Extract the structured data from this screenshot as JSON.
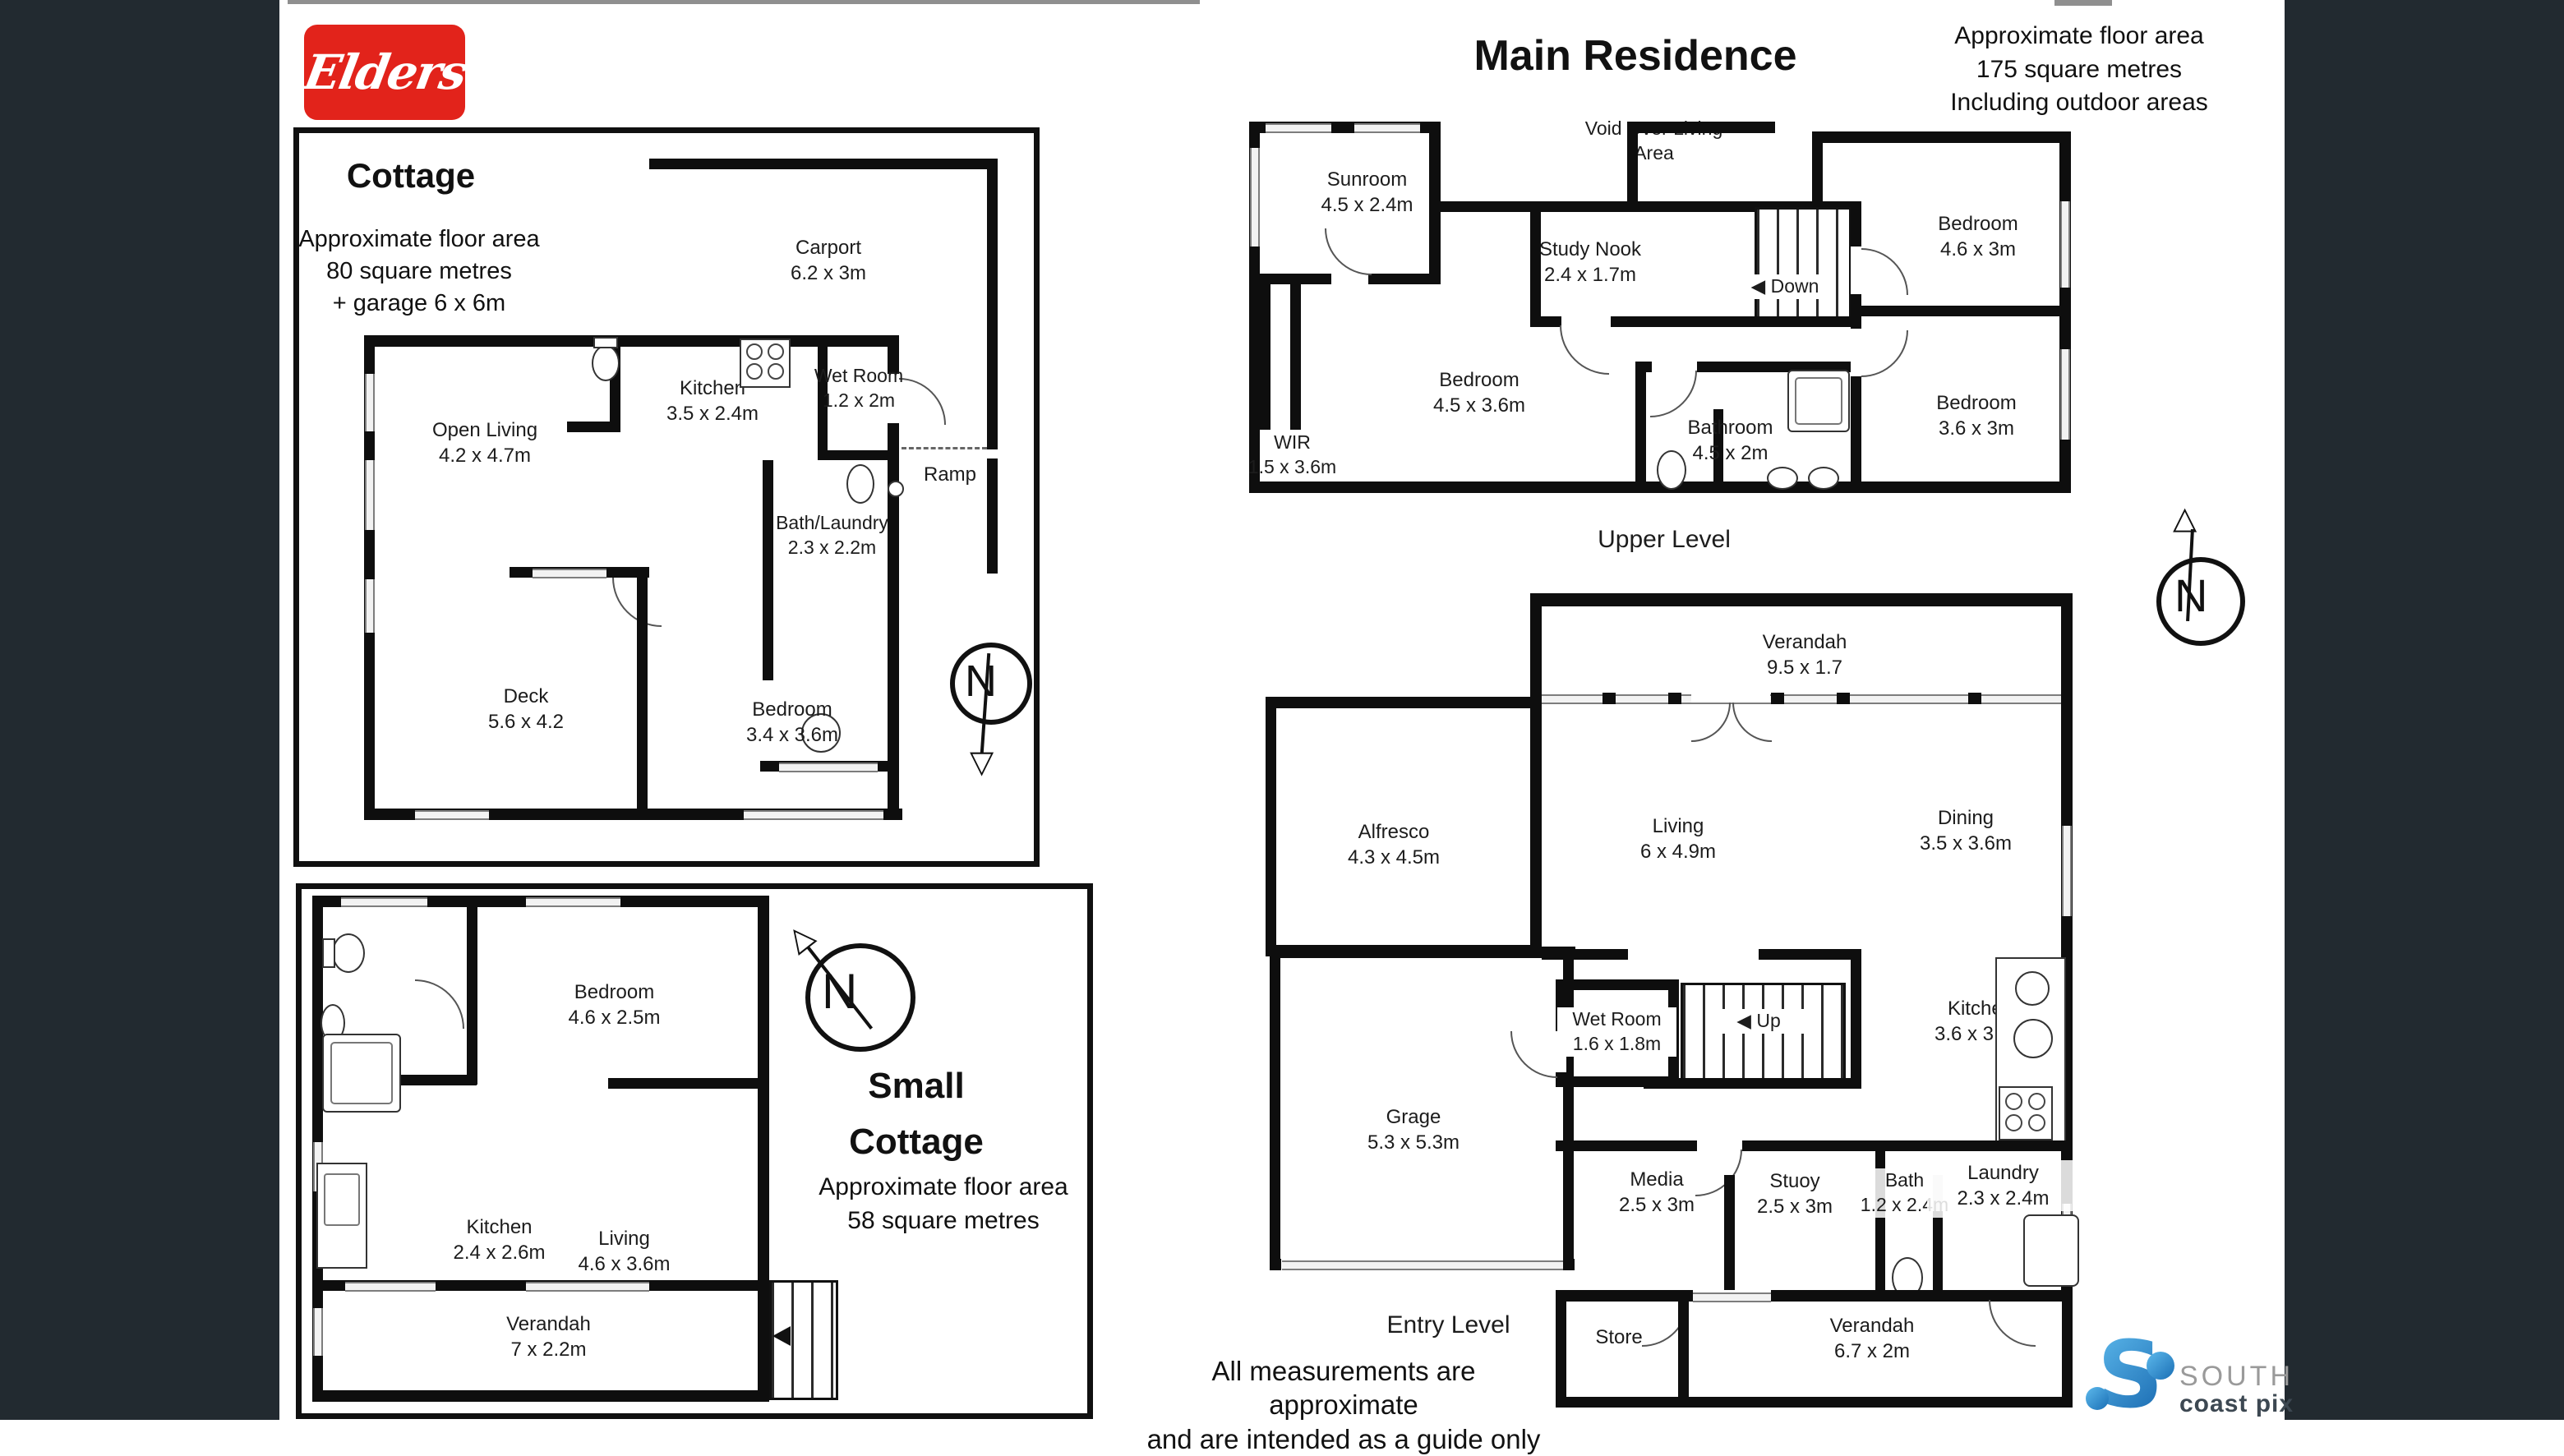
{
  "page": {
    "side_panel_color": "#222a30"
  },
  "logo": {
    "brand": "Elders",
    "brand_bg": "#e2231b"
  },
  "compass": {
    "letter": "N"
  },
  "icons": {
    "stair_arrow": "◀",
    "triangle_up": "△",
    "triangle_down": "▽"
  },
  "cottage": {
    "title": "Cottage",
    "area_lines": [
      "Approximate floor area",
      "80 square metres",
      "+ garage 6 x 6m"
    ],
    "rooms": [
      {
        "name": "Carport",
        "dims": "6.2 x 3m"
      },
      {
        "name": "Kitchen",
        "dims": "3.5 x 2.4m"
      },
      {
        "name": "Wet Room",
        "dims": "1.2 x 2m"
      },
      {
        "name": "Open Living",
        "dims": "4.2 x 4.7m"
      },
      {
        "name": "Bath/Laundry",
        "dims": "2.3 x 2.2m"
      },
      {
        "name": "Deck",
        "dims": "5.6 x 4.2"
      },
      {
        "name": "Bedroom",
        "dims": "3.4 x 3.6m"
      },
      {
        "name": "Ramp",
        "dims": ""
      }
    ]
  },
  "small_cottage": {
    "title_lines": [
      "Small",
      "Cottage"
    ],
    "area_lines": [
      "Approximate floor area",
      "58 square metres"
    ],
    "rooms": [
      {
        "name": "Bedroom",
        "dims": "4.6 x 2.5m"
      },
      {
        "name": "Kitchen",
        "dims": "2.4 x 2.6m"
      },
      {
        "name": "Living",
        "dims": "4.6 x 3.6m"
      },
      {
        "name": "Verandah",
        "dims": "7 x 2.2m"
      }
    ]
  },
  "main_residence": {
    "title": "Main Residence",
    "area_lines": [
      "Approximate floor area",
      "175 square metres",
      "Including outdoor areas"
    ],
    "upper": {
      "level_label": "Upper Level",
      "void_label": "Void Over Living Area",
      "stairs_label": "Down",
      "rooms": [
        {
          "name": "Sunroom",
          "dims": "4.5 x 2.4m"
        },
        {
          "name": "Study Nook",
          "dims": "2.4 x 1.7m"
        },
        {
          "name": "Bedroom",
          "dims": "4.6 x 3m"
        },
        {
          "name": "Bedroom",
          "dims": "4.5 x 3.6m"
        },
        {
          "name": "WIR",
          "dims": "1.5 x 3.6m"
        },
        {
          "name": "Bathroom",
          "dims": "4.5 x 2m"
        },
        {
          "name": "Bedroom",
          "dims": "3.6 x 3m"
        }
      ]
    },
    "entry": {
      "level_label": "Entry Level",
      "stairs_label": "Up",
      "rooms": [
        {
          "name": "Verandah",
          "dims": "9.5 x 1.7"
        },
        {
          "name": "Alfresco",
          "dims": "4.3 x 4.5m"
        },
        {
          "name": "Living",
          "dims": "6 x 4.9m"
        },
        {
          "name": "Dining",
          "dims": "3.5 x 3.6m"
        },
        {
          "name": "Wet Room",
          "dims": "1.6 x 1.8m"
        },
        {
          "name": "Kitchen",
          "dims": "3.6 x 3.6m"
        },
        {
          "name": "Grage",
          "dims": "5.3 x 5.3m"
        },
        {
          "name": "Media",
          "dims": "2.5 x 3m"
        },
        {
          "name": "Stuoy",
          "dims": "2.5 x 3m"
        },
        {
          "name": "Bath",
          "dims": "1.2 x 2.4m"
        },
        {
          "name": "Laundry",
          "dims": "2.3 x 2.4m"
        },
        {
          "name": "Store",
          "dims": ""
        },
        {
          "name": "Verandah",
          "dims": "6.7 x 2m"
        }
      ]
    }
  },
  "disclaimer": {
    "line1": "All measurements are approximate",
    "line2": "and are intended as a guide only"
  },
  "photographer": {
    "word1": "SOUTH",
    "word2": "coast pix",
    "mark": "S"
  }
}
